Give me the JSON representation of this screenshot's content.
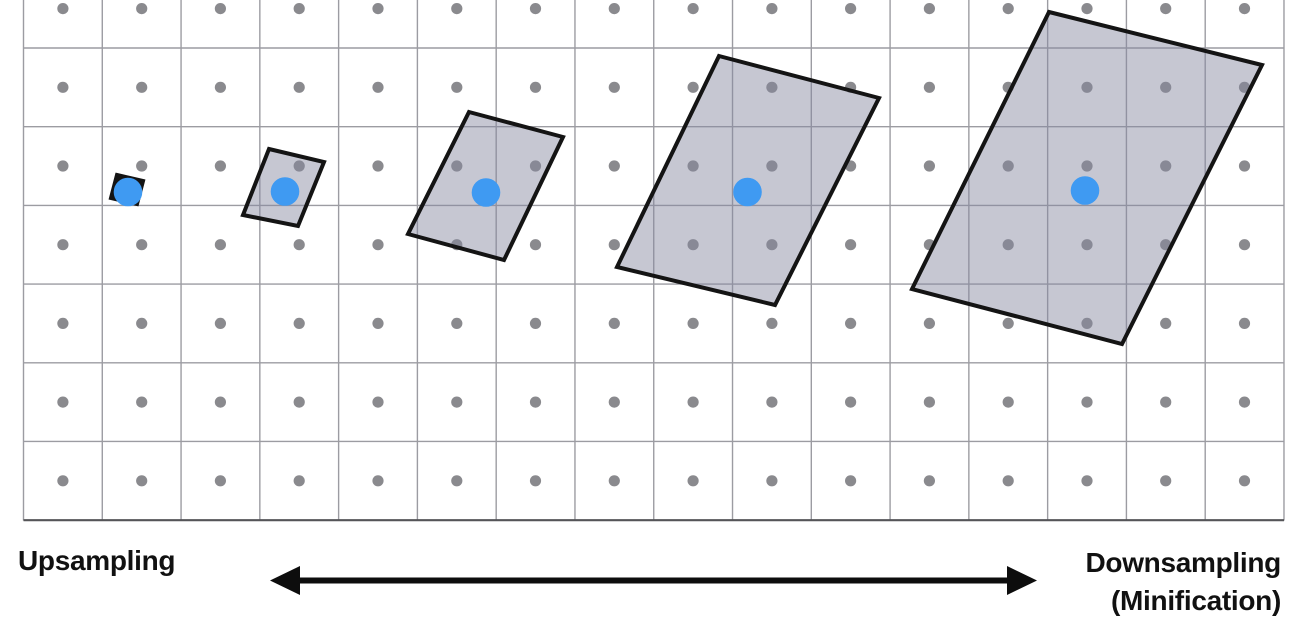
{
  "page": {
    "background": "#ffffff"
  },
  "labels": {
    "upsampling": "Upsampling",
    "downsampling_line1": "Downsampling",
    "downsampling_line2": "(Minification)"
  },
  "diagram": {
    "width": 1305,
    "height": 623,
    "grid": {
      "x_start": 23.5,
      "x_end": 1284,
      "y_top": 0,
      "y_bottom": 520.5,
      "v_line_count": 17,
      "cell_size": 78.78,
      "h_line_ys": [
        48,
        126.7,
        205.4,
        284.1,
        362.8,
        441.4,
        520.2
      ],
      "line_color": "#9c9ca2",
      "line_width": 1.4,
      "bottom_line_color": "#555558",
      "bottom_line_width": 2.2
    },
    "texel_dots": {
      "color": "#8a8a8e",
      "radius": 5.6,
      "col_xs": [
        62.9,
        141.7,
        220.4,
        299.2,
        378.0,
        456.8,
        535.5,
        614.3,
        693.1,
        771.9,
        850.6,
        929.4,
        1008.2,
        1087.0,
        1165.7,
        1244.5
      ],
      "row_ys": [
        8.6,
        87.3,
        166.0,
        244.7,
        323.4,
        402.1,
        480.8
      ]
    },
    "footprints": {
      "fill": "rgba(133,136,160,0.47)",
      "stroke": "#141414",
      "stroke_width": 4,
      "quads": [
        {
          "points": [
            [
              117,
              175
            ],
            [
              143,
              181
            ],
            [
              137,
              204
            ],
            [
              111,
              198
            ]
          ],
          "fill": "#141414"
        },
        {
          "points": [
            [
              269,
              149
            ],
            [
              324,
              162
            ],
            [
              298,
              226
            ],
            [
              243,
              215
            ]
          ]
        },
        {
          "points": [
            [
              469,
              112
            ],
            [
              563,
              137
            ],
            [
              504,
              260
            ],
            [
              408,
              234
            ]
          ]
        },
        {
          "points": [
            [
              719,
              56
            ],
            [
              879,
              98
            ],
            [
              775,
              305
            ],
            [
              617,
              267
            ]
          ]
        },
        {
          "points": [
            [
              1049,
              12
            ],
            [
              1262,
              65
            ],
            [
              1122,
              344
            ],
            [
              912,
              289
            ]
          ]
        }
      ]
    },
    "sample_points": {
      "color": "#3f9af2",
      "radius": 14.3,
      "points": [
        [
          128,
          192
        ],
        [
          285,
          191.5
        ],
        [
          486,
          192.5
        ],
        [
          747.5,
          192
        ],
        [
          1085,
          190.5
        ]
      ]
    },
    "arrow": {
      "x_left": 270,
      "x_right": 1037,
      "y": 580.5,
      "color": "#0d0d0d",
      "shaft_height": 6,
      "head_length": 30,
      "head_width": 29
    }
  }
}
